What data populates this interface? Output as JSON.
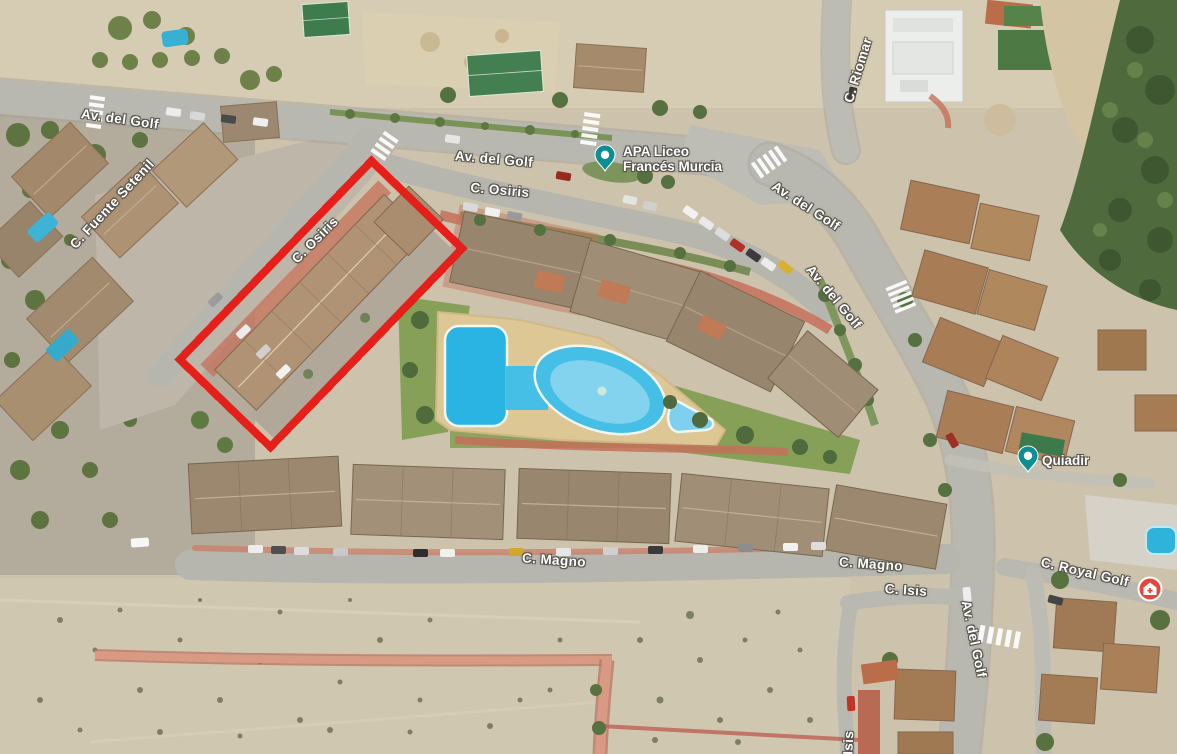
{
  "map": {
    "view_type": "satellite",
    "colors": {
      "annotation": "#e51f1a",
      "poi_pin": "#0c8e93",
      "poi_icon_red": "#e8453c",
      "label_text": "#ffffff",
      "label_outline": "#55524a"
    },
    "annotation": {
      "shape": "rectangle-outline",
      "purpose": "highlighted building on C. Osiris",
      "rotation_deg": -46,
      "stroke_px": 8
    },
    "road_labels": [
      {
        "id": "av-del-golf-top-west",
        "text": "Av. del Golf"
      },
      {
        "id": "av-del-golf-top-mid",
        "text": "Av. del Golf"
      },
      {
        "id": "c-osiris-east",
        "text": "C. Osiris"
      },
      {
        "id": "c-osiris-diagonal",
        "text": "C. Osiris"
      },
      {
        "id": "c-fuente-setenil",
        "text": "C. Fuente Setenil"
      },
      {
        "id": "c-riomar",
        "text": "C. Riomar"
      },
      {
        "id": "av-del-golf-right-1",
        "text": "Av. del Golf"
      },
      {
        "id": "av-del-golf-right-2",
        "text": "Av. del Golf"
      },
      {
        "id": "c-magno-west",
        "text": "C. Magno"
      },
      {
        "id": "c-magno-east",
        "text": "C. Magno"
      },
      {
        "id": "c-isis-east",
        "text": "C. Isis"
      },
      {
        "id": "c-royal-golf",
        "text": "C. Royal Golf"
      },
      {
        "id": "av-del-golf-south",
        "text": "Av. del Golf"
      },
      {
        "id": "c-isis-south",
        "text": "C. Isis"
      }
    ],
    "pois": [
      {
        "id": "apa-liceo-frances-murcia",
        "icon": "map-pin-icon",
        "line1": "APA Liceo",
        "line2": "Francés Murcia"
      },
      {
        "id": "quiadir",
        "icon": "map-pin-icon",
        "line1": "Quiadir",
        "line2": ""
      },
      {
        "id": "red-place-marker",
        "icon": "home-cross-icon",
        "line1": "",
        "line2": ""
      }
    ]
  }
}
